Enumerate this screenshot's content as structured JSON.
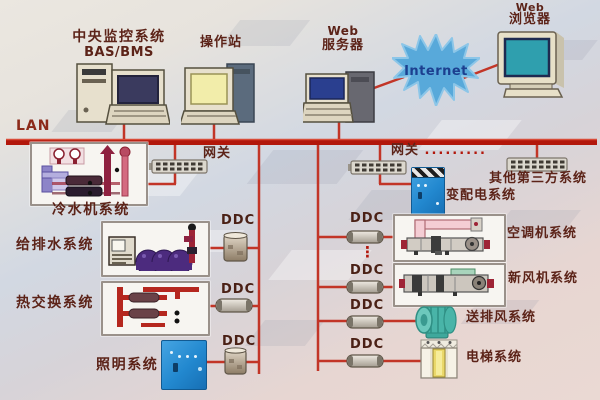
{
  "top": {
    "central_label1": "中央监控系统",
    "central_label2": "BAS/BMS",
    "operator_label": "操作站",
    "webserver_label1": "Web",
    "webserver_label2": "服务器",
    "internet_label": "Internet",
    "browser_label1": "Web",
    "browser_label2": "浏览器"
  },
  "lan_label": "LAN",
  "gateway": {
    "left_label": "网关",
    "right_label": "网关",
    "right_dots": ".........",
    "vertical_dots": "⋮",
    "third_party_label": "其他第三方系统"
  },
  "ddc": {
    "l1": "DDC",
    "l2": "DDC",
    "l3": "DDC",
    "r1": "DDC",
    "r2": "DDC",
    "r3": "DDC",
    "r4": "DDC"
  },
  "systems": {
    "chiller": "冷水机系统",
    "water": "给排水系统",
    "heat_exchange": "热交换系统",
    "lighting": "照明系统",
    "power_distribution": "变配电系统",
    "air_handling": "空调机系统",
    "fresh_air": "新风机系统",
    "supply_exhaust": "送排风系统",
    "elevator": "电梯系统"
  },
  "colors": {
    "line_red": "#c23527",
    "lan_red": "#b2170b",
    "label_maroon": "#5c2318",
    "internet_blue": "#1c3f8f",
    "internet_star": "#58a9da",
    "cabinet_blue": "#2288cf",
    "fan_teal": "#49b4a8",
    "browser_screen_teal": "#2f9fae",
    "operator_screen_yellow": "#f2edaa",
    "pump_purple": "#4c2b7e"
  }
}
